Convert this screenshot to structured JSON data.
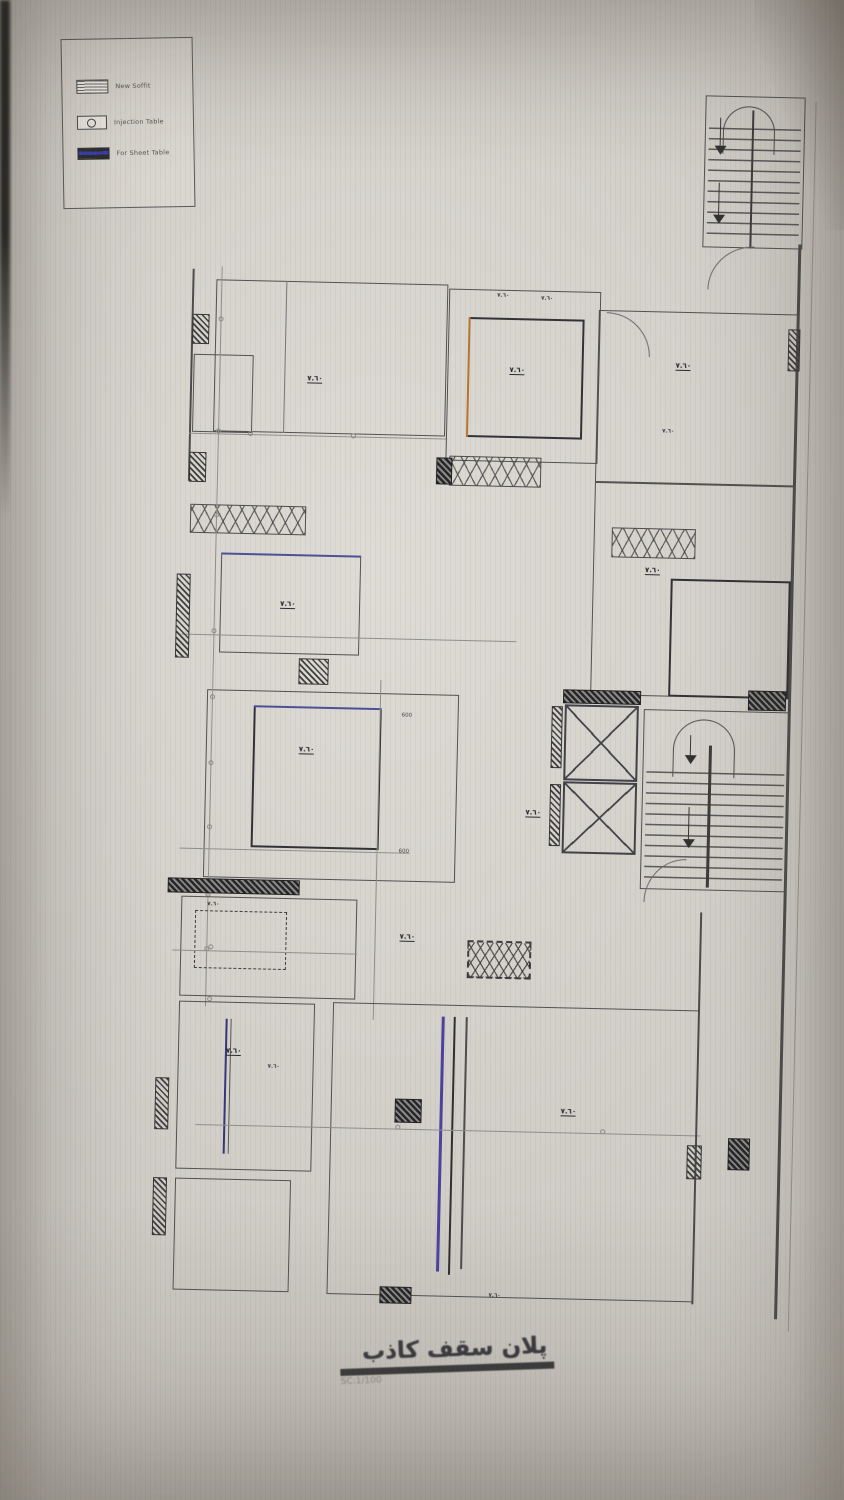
{
  "photo": {
    "background": "#cfccc6"
  },
  "legend": {
    "items": [
      {
        "symbol": "soffit-hatch-symbol",
        "label": "New Soffit"
      },
      {
        "symbol": "table-circle-symbol",
        "label": "Injection Table"
      },
      {
        "symbol": "sheet-filled-symbol",
        "label": "For Sheet Table"
      }
    ]
  },
  "title_block": {
    "title": "پلان سقف کاذب",
    "scale": "SC:1/100"
  },
  "plan": {
    "elements": [
      {
        "name": "stair-top-enclosure",
        "type": "room",
        "x": 542,
        "y": -172,
        "w": 100,
        "h": 152
      },
      {
        "name": "stair-top-treads",
        "type": "stair-v",
        "x": 546,
        "y": -140,
        "w": 92,
        "h": 115
      },
      {
        "name": "stair-top-midwall",
        "type": "line-v",
        "x": 589,
        "y": -158,
        "w": 2,
        "h": 138,
        "color": "#3a3a3a"
      },
      {
        "name": "stair-top-arc",
        "type": "arc",
        "x": 560,
        "y": -162,
        "w": 52,
        "h": 48
      },
      {
        "name": "stair-top-stem1",
        "type": "line-v",
        "x": 557,
        "y": -150,
        "w": 1,
        "h": 28,
        "color": "#333"
      },
      {
        "name": "stair-top-arrow1",
        "type": "arrow-down",
        "x": 552,
        "y": -122
      },
      {
        "name": "stair-top-stem2",
        "type": "line-v",
        "x": 557,
        "y": -85,
        "w": 1,
        "h": 32,
        "color": "#333"
      },
      {
        "name": "stair-top-arrow2",
        "type": "arrow-down",
        "x": 552,
        "y": -53
      },
      {
        "name": "sheet-edge",
        "type": "line-v",
        "x": 652,
        "y": -168,
        "w": 1,
        "h": 1230,
        "color": "#9a968e"
      },
      {
        "name": "door-arc-under-stair",
        "type": "arc-tl",
        "x": 548,
        "y": -22,
        "w": 46,
        "h": 44
      },
      {
        "name": "outer-wall-left-top",
        "type": "line-v",
        "x": 33,
        "y": 13,
        "w": 2,
        "h": 212,
        "color": "#4a4a4a"
      },
      {
        "name": "wall-hatch",
        "type": "hatch",
        "x": 34,
        "y": 58,
        "w": 17,
        "h": 30
      },
      {
        "name": "wall-hatch",
        "type": "hatch",
        "x": 34,
        "y": 196,
        "w": 17,
        "h": 30
      },
      {
        "name": "room-top-left",
        "type": "room",
        "x": 57,
        "y": 23,
        "w": 232,
        "h": 152
      },
      {
        "name": "partition",
        "type": "line-v",
        "x": 127,
        "y": 23,
        "w": 1,
        "h": 152,
        "color": "#777"
      },
      {
        "name": "closet",
        "type": "room",
        "x": 36,
        "y": 98,
        "w": 60,
        "h": 78
      },
      {
        "name": "ceiling-label",
        "type": "label",
        "x": 150,
        "y": 116,
        "text": "٧.٦٠"
      },
      {
        "name": "dim",
        "type": "dim-h",
        "x": 33,
        "y": 177,
        "w": 258
      },
      {
        "name": "dim-tick",
        "type": "tick",
        "x": 92,
        "y": 174
      },
      {
        "name": "dim-tick",
        "type": "tick",
        "x": 195,
        "y": 174
      },
      {
        "name": "xstrip-left",
        "type": "xstrip",
        "x": 36,
        "y": 248,
        "w": 116,
        "h": 29
      },
      {
        "name": "room-blue-top",
        "type": "room",
        "x": 68,
        "y": 296,
        "w": 140,
        "h": 100
      },
      {
        "name": "blue-edge",
        "type": "line-h",
        "x": 68,
        "y": 296,
        "w": 140,
        "h": 2,
        "color": "#4a4f9a"
      },
      {
        "name": "ceiling-label",
        "type": "label",
        "x": 128,
        "y": 342,
        "text": "٧.٦٠"
      },
      {
        "name": "dim",
        "type": "dim-h",
        "x": 30,
        "y": 378,
        "w": 335
      },
      {
        "name": "wall-hatch",
        "type": "hatch",
        "x": 148,
        "y": 400,
        "w": 30,
        "h": 26
      },
      {
        "name": "wall-hatch",
        "type": "hatch",
        "x": 24,
        "y": 318,
        "w": 14,
        "h": 84
      },
      {
        "name": "hall-room",
        "type": "room",
        "x": 57,
        "y": 433,
        "w": 252,
        "h": 188
      },
      {
        "name": "ceiling-panel",
        "type": "room2",
        "x": 104,
        "y": 448,
        "w": 128,
        "h": 142
      },
      {
        "name": "blue-edge",
        "type": "line-h",
        "x": 104,
        "y": 448,
        "w": 128,
        "h": 2,
        "color": "#4a4f9a"
      },
      {
        "name": "ceiling-label",
        "type": "label",
        "x": 150,
        "y": 487,
        "text": "٧.٦٠"
      },
      {
        "name": "dim-long-left",
        "type": "dim-v",
        "x": 62,
        "y": 10,
        "w": 1,
        "h": 740
      },
      {
        "name": "dim-tick",
        "type": "tick",
        "x": 60,
        "y": 60
      },
      {
        "name": "dim-tick",
        "type": "tick",
        "x": 60,
        "y": 172
      },
      {
        "name": "dim-tick",
        "type": "tick",
        "x": 60,
        "y": 256
      },
      {
        "name": "dim-tick",
        "type": "tick",
        "x": 60,
        "y": 372
      },
      {
        "name": "dim-tick",
        "type": "tick",
        "x": 60,
        "y": 438
      },
      {
        "name": "dim-tick",
        "type": "tick",
        "x": 60,
        "y": 504
      },
      {
        "name": "dim-tick",
        "type": "tick",
        "x": 60,
        "y": 568
      },
      {
        "name": "dim-tick",
        "type": "tick",
        "x": 60,
        "y": 636
      },
      {
        "name": "dim-tick",
        "type": "tick",
        "x": 60,
        "y": 690
      },
      {
        "name": "dim-num",
        "type": "num",
        "x": 252,
        "y": 452,
        "text": "600"
      },
      {
        "name": "dim-num",
        "type": "num",
        "x": 252,
        "y": 588,
        "text": "600"
      },
      {
        "name": "dim",
        "type": "dim-h",
        "x": 33,
        "y": 592,
        "w": 230
      },
      {
        "name": "dim-center-vert",
        "type": "dim-v",
        "x": 230,
        "y": 420,
        "w": 1,
        "h": 340
      },
      {
        "name": "dark-wall-bar",
        "type": "hatch-dark",
        "x": 22,
        "y": 622,
        "w": 132,
        "h": 15
      },
      {
        "name": "room-dashed-panel",
        "type": "room",
        "x": 36,
        "y": 640,
        "w": 176,
        "h": 100
      },
      {
        "name": "dashed-panel",
        "type": "dashed",
        "x": 50,
        "y": 654,
        "w": 92,
        "h": 58
      },
      {
        "name": "ceiling-label",
        "type": "label-tiny",
        "x": 62,
        "y": 645,
        "text": "٧.٦٠"
      },
      {
        "name": "dim",
        "type": "dim-h",
        "x": 28,
        "y": 694,
        "w": 185
      },
      {
        "name": "dim-tick",
        "type": "tick",
        "x": 64,
        "y": 688
      },
      {
        "name": "dim-tick",
        "type": "tick",
        "x": 64,
        "y": 740
      },
      {
        "name": "room-lower-left",
        "type": "room",
        "x": 36,
        "y": 745,
        "w": 136,
        "h": 168
      },
      {
        "name": "blue-duct-line",
        "type": "line-v",
        "x": 83,
        "y": 762,
        "w": 2,
        "h": 135,
        "color": "#33337a"
      },
      {
        "name": "duct-line",
        "type": "line-v",
        "x": 88,
        "y": 762,
        "w": 1,
        "h": 135,
        "color": "#555"
      },
      {
        "name": "ceiling-label",
        "type": "label",
        "x": 84,
        "y": 790,
        "text": "٧.٦٠"
      },
      {
        "name": "ceiling-label",
        "type": "label-tiny",
        "x": 126,
        "y": 806,
        "text": "٧.٦٠"
      },
      {
        "name": "wall-hatch",
        "type": "hatch",
        "x": 14,
        "y": 822,
        "w": 14,
        "h": 52
      },
      {
        "name": "room-bottom-left",
        "type": "room",
        "x": 36,
        "y": 922,
        "w": 116,
        "h": 112
      },
      {
        "name": "wall-hatch",
        "type": "hatch",
        "x": 14,
        "y": 922,
        "w": 14,
        "h": 58
      },
      {
        "name": "living-room",
        "type": "room",
        "x": 190,
        "y": 743,
        "w": 366,
        "h": 292
      },
      {
        "name": "purple-line",
        "type": "line-v",
        "x": 299,
        "y": 755,
        "w": 3,
        "h": 255,
        "color": "#4a3f9e"
      },
      {
        "name": "dark-line",
        "type": "line-v",
        "x": 311,
        "y": 755,
        "w": 2,
        "h": 258,
        "color": "#2c2c2c"
      },
      {
        "name": "dark-line",
        "type": "line-v",
        "x": 323,
        "y": 755,
        "w": 2,
        "h": 252,
        "color": "#4a4a4a"
      },
      {
        "name": "column-hatch",
        "type": "hatch-dark",
        "x": 254,
        "y": 838,
        "w": 27,
        "h": 24
      },
      {
        "name": "ceiling-label",
        "type": "label",
        "x": 255,
        "y": 672,
        "text": "٧.٦٠"
      },
      {
        "name": "ceiling-label",
        "type": "label",
        "x": 420,
        "y": 843,
        "text": "٧.٦٠"
      },
      {
        "name": "dim",
        "type": "dim-h",
        "x": 55,
        "y": 868,
        "w": 505
      },
      {
        "name": "dim-tick",
        "type": "tick",
        "x": 255,
        "y": 864
      },
      {
        "name": "dim-tick",
        "type": "tick",
        "x": 460,
        "y": 864
      },
      {
        "name": "diffuser-strip",
        "type": "xstrip-dashed",
        "x": 323,
        "y": 678,
        "w": 64,
        "h": 38
      },
      {
        "name": "dark-wall-bar",
        "type": "hatch-dark",
        "x": 243,
        "y": 1026,
        "w": 32,
        "h": 17
      },
      {
        "name": "ceiling-label",
        "type": "label-tiny",
        "x": 352,
        "y": 1030,
        "text": "٧.٦٠"
      },
      {
        "name": "room-top-mid",
        "type": "room",
        "x": 290,
        "y": 27,
        "w": 152,
        "h": 172
      },
      {
        "name": "ceiling-panel",
        "type": "room2",
        "x": 310,
        "y": 55,
        "w": 116,
        "h": 120
      },
      {
        "name": "orange-edge",
        "type": "line-v",
        "x": 310,
        "y": 55,
        "w": 2,
        "h": 120,
        "color": "#b8742c"
      },
      {
        "name": "ceiling-label",
        "type": "label",
        "x": 352,
        "y": 103,
        "text": "٧.٦٠"
      },
      {
        "name": "ceiling-label",
        "type": "label-tiny",
        "x": 338,
        "y": 30,
        "text": "٧.٦٠"
      },
      {
        "name": "ceiling-label",
        "type": "label-tiny",
        "x": 382,
        "y": 32,
        "text": "٧.٦٠"
      },
      {
        "name": "diffuser-strip",
        "type": "xstrip",
        "x": 294,
        "y": 194,
        "w": 92,
        "h": 30
      },
      {
        "name": "strip-end-hatch",
        "type": "hatch-dark",
        "x": 281,
        "y": 196,
        "w": 16,
        "h": 27
      },
      {
        "name": "room-top-right",
        "type": "room",
        "x": 440,
        "y": 45,
        "w": 200,
        "h": 172
      },
      {
        "name": "door-arc",
        "type": "arc-tr",
        "x": 448,
        "y": 47,
        "w": 44,
        "h": 44
      },
      {
        "name": "ceiling-label",
        "type": "label",
        "x": 518,
        "y": 95,
        "text": "٧.٦٠"
      },
      {
        "name": "ceiling-label",
        "type": "label-tiny",
        "x": 506,
        "y": 162,
        "text": "٧.٦٠"
      },
      {
        "name": "outer-wall-right",
        "type": "line-v",
        "x": 638,
        "y": -25,
        "w": 3,
        "h": 1075,
        "color": "#4a4a4a"
      },
      {
        "name": "wall-hatch",
        "type": "hatch",
        "x": 630,
        "y": 60,
        "w": 12,
        "h": 42
      },
      {
        "name": "room-mid-right",
        "type": "room",
        "x": 440,
        "y": 217,
        "w": 200,
        "h": 213
      },
      {
        "name": "diffuser-strip",
        "type": "xstrip",
        "x": 458,
        "y": 262,
        "w": 84,
        "h": 30
      },
      {
        "name": "ceiling-label",
        "type": "label",
        "x": 492,
        "y": 300,
        "text": "٧.٦٠"
      },
      {
        "name": "ceiling-panel",
        "type": "room2",
        "x": 518,
        "y": 312,
        "w": 120,
        "h": 118
      },
      {
        "name": "dark-wall-bar",
        "type": "hatch-dark",
        "x": 598,
        "y": 422,
        "w": 38,
        "h": 20
      },
      {
        "name": "elevator-top-hatch",
        "type": "hatch-dark",
        "x": 413,
        "y": 425,
        "w": 78,
        "h": 14
      },
      {
        "name": "elevator-shaft",
        "type": "xbox",
        "x": 415,
        "y": 440,
        "w": 74,
        "h": 76
      },
      {
        "name": "elevator-shaft",
        "type": "xbox",
        "x": 415,
        "y": 517,
        "w": 74,
        "h": 72
      },
      {
        "name": "wall-hatch",
        "type": "hatch",
        "x": 402,
        "y": 442,
        "w": 11,
        "h": 62
      },
      {
        "name": "wall-hatch",
        "type": "hatch",
        "x": 402,
        "y": 520,
        "w": 11,
        "h": 62
      },
      {
        "name": "ceiling-label",
        "type": "label",
        "x": 378,
        "y": 545,
        "text": "٧.٦٠"
      },
      {
        "name": "stair-core-enclosure",
        "type": "room",
        "x": 494,
        "y": 443,
        "w": 146,
        "h": 180
      },
      {
        "name": "stair-core-arc",
        "type": "arc",
        "x": 524,
        "y": 452,
        "w": 62,
        "h": 58
      },
      {
        "name": "stair-core-treads",
        "type": "stair-v",
        "x": 498,
        "y": 505,
        "w": 138,
        "h": 112
      },
      {
        "name": "stair-core-midwall",
        "type": "line-v",
        "x": 560,
        "y": 478,
        "w": 3,
        "h": 142,
        "color": "#3a3a3a"
      },
      {
        "name": "stair-stem",
        "type": "line-v",
        "x": 541,
        "y": 468,
        "w": 1,
        "h": 22,
        "color": "#333"
      },
      {
        "name": "stair-arrow",
        "type": "arrow-down",
        "x": 536,
        "y": 488
      },
      {
        "name": "stair-stem",
        "type": "line-v",
        "x": 541,
        "y": 540,
        "w": 1,
        "h": 32,
        "color": "#333"
      },
      {
        "name": "stair-arrow",
        "type": "arrow-down",
        "x": 536,
        "y": 572
      },
      {
        "name": "door-arc",
        "type": "arc-tl",
        "x": 498,
        "y": 592,
        "w": 42,
        "h": 44
      },
      {
        "name": "wall-right-lower",
        "type": "line-v",
        "x": 555,
        "y": 645,
        "w": 2,
        "h": 392,
        "color": "#4a4a4a"
      },
      {
        "name": "wall-hatch",
        "type": "hatch",
        "x": 547,
        "y": 878,
        "w": 15,
        "h": 34
      },
      {
        "name": "dark-wall-bar",
        "type": "hatch-dark",
        "x": 588,
        "y": 870,
        "w": 22,
        "h": 32
      }
    ]
  }
}
